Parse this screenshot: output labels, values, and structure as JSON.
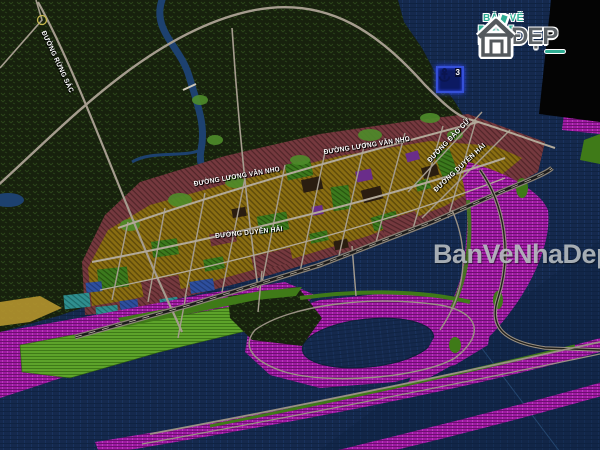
{
  "map": {
    "street_labels": [
      {
        "text": "ĐƯỜNG RỪNG SÁC"
      },
      {
        "text": "ĐƯỜNG LƯƠNG VĂN NHO"
      },
      {
        "text": "ĐƯỜNG LƯƠNG VĂN NHO"
      },
      {
        "text": "ĐƯỜNG ĐÀO CỬ"
      },
      {
        "text": "ĐƯỜNG DUYÊN HẢI"
      },
      {
        "text": "ĐƯỜNG DUYÊN HẢI"
      }
    ],
    "marker": {
      "count": "3",
      "icon": "anchor-icon"
    },
    "colors": {
      "water": "#15294d",
      "forest": "#17210d",
      "urban_block": "#8a6e12",
      "mixed_zone": "#75393e",
      "tourism_zone": "#a01aa4",
      "park_green": "#3c7a1d",
      "field_green": "#5da32a",
      "road": "#a59c8e",
      "corner_mask": "#040404"
    }
  },
  "branding": {
    "logo": {
      "line1": "BẢN VẼ",
      "word_left": "NH",
      "word_right": "ĐẸP"
    },
    "watermark": "BanVeNhaDep.v"
  }
}
